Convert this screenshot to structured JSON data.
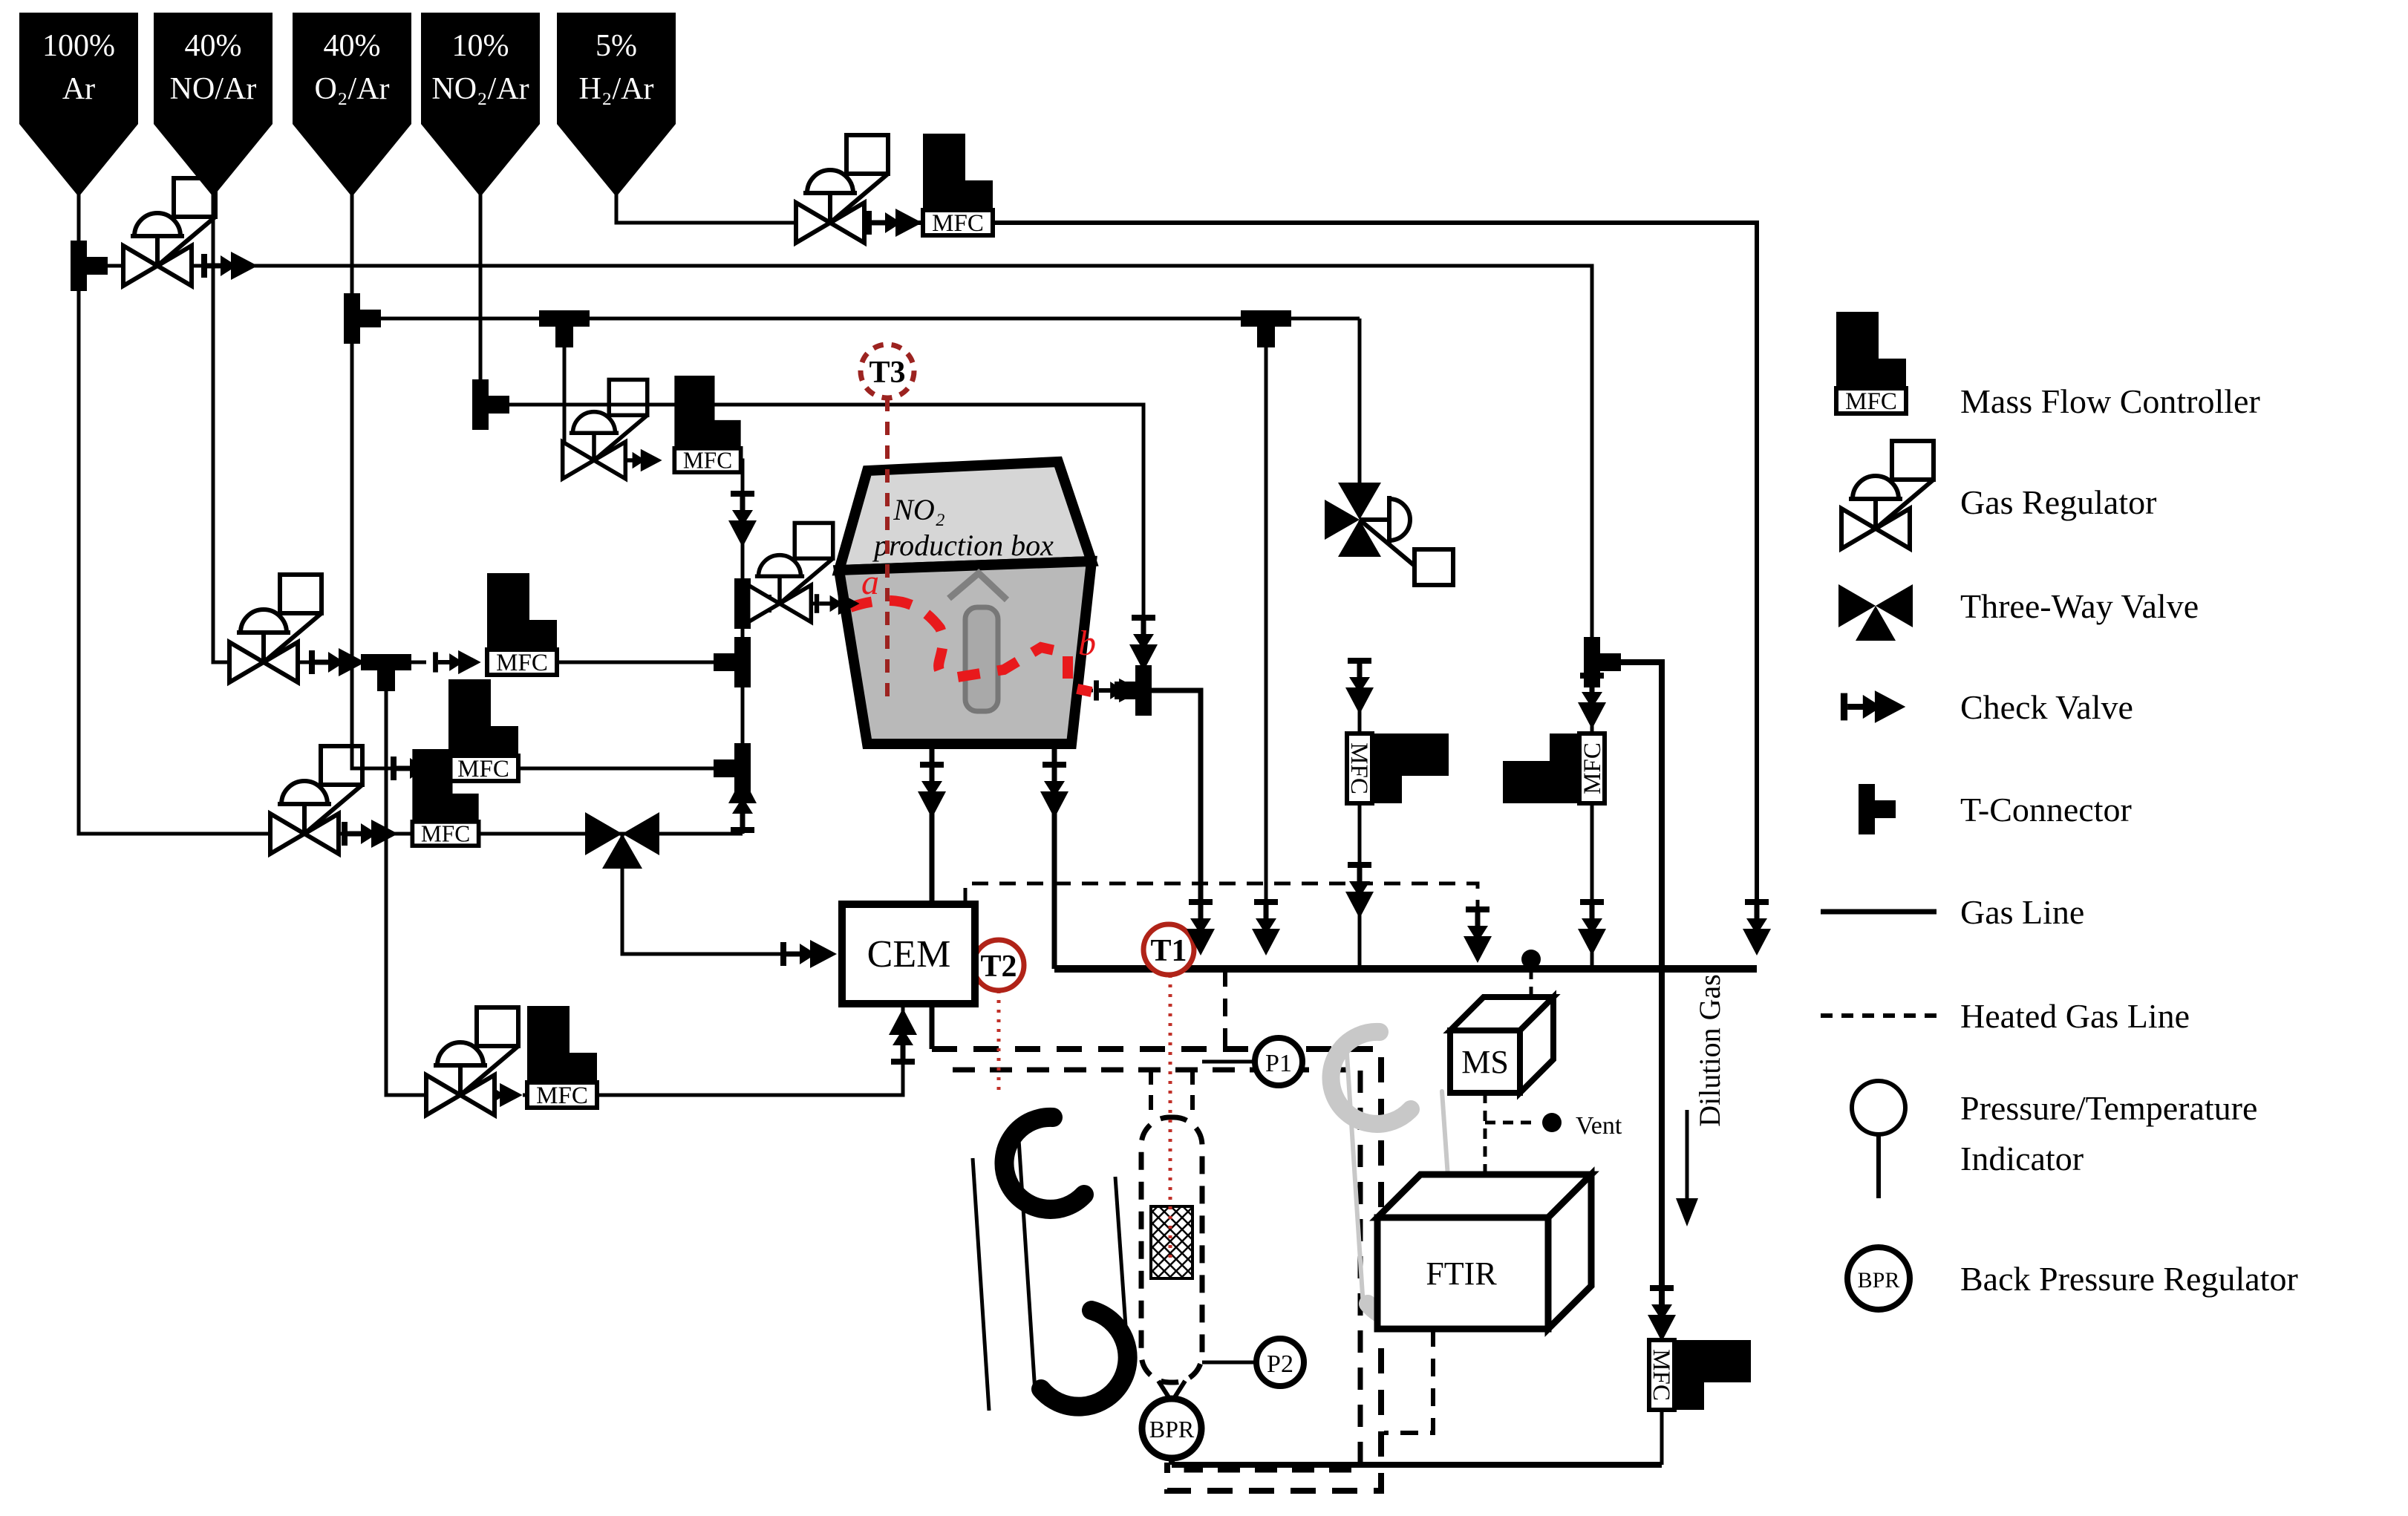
{
  "figure_type": "gas-flow-experimental-setup-diagram",
  "cylinders": [
    {
      "line1": "100%",
      "line2": "Ar"
    },
    {
      "line1": "40%",
      "line2": "NO/Ar"
    },
    {
      "line1": "40%",
      "line2": "O₂/Ar"
    },
    {
      "line1": "10%",
      "line2": "NO₂/Ar"
    },
    {
      "line1": "5%",
      "line2": "H₂/Ar"
    }
  ],
  "labels": {
    "mfc": "MFC",
    "cem": "CEM",
    "ftir": "FTIR",
    "ms": "MS",
    "bpr": "BPR",
    "p1": "P1",
    "p2": "P2",
    "t1": "T1",
    "t2": "T2",
    "t3": "T3",
    "vent": "Vent",
    "dilution_gas": "Dilution Gas",
    "box_title_line1": "NO₂",
    "box_title_line2": "production box",
    "annotation_a": "a",
    "annotation_b": "b"
  },
  "legend": {
    "mass_flow_controller": "Mass Flow Controller",
    "gas_regulator": "Gas Regulator",
    "three_way_valve": "Three-Way Valve",
    "check_valve": "Check Valve",
    "t_connector": "T-Connector",
    "gas_line": "Gas Line",
    "heated_gas_line": "Heated Gas Line",
    "pt_indicator_line1": "Pressure/Temperature",
    "pt_indicator_line2": "Indicator",
    "back_pressure_regulator": "Back Pressure Regulator",
    "mfc_icon_label": "MFC",
    "bpr_icon_label": "BPR"
  },
  "colors": {
    "line": "#000000",
    "annotation_red": "#e8191c",
    "indicator_red": "#a63029",
    "box_gray_front": "#b9b9b9",
    "box_gray_top": "#d6d6d6"
  }
}
